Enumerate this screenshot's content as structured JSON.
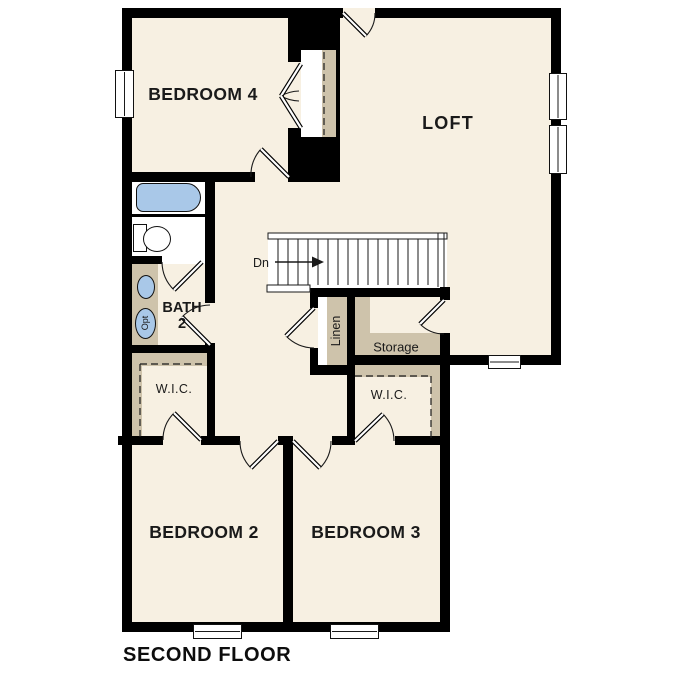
{
  "title": "SECOND FLOOR",
  "colors": {
    "background": "#ffffff",
    "floor": "#f7f0e2",
    "wall": "#000000",
    "closet_tan": "#cec3ab",
    "fixture_blue": "#a9c8e8",
    "line": "#1a1a1a"
  },
  "rooms": {
    "bedroom4": {
      "label": "BEDROOM 4"
    },
    "loft": {
      "label": "LOFT"
    },
    "bath": {
      "label_line1": "BATH",
      "label_line2": "2"
    },
    "wic_left": {
      "label": "W.I.C."
    },
    "wic_right": {
      "label": "W.I.C."
    },
    "bedroom2": {
      "label": "BEDROOM 2"
    },
    "bedroom3": {
      "label": "BEDROOM 3"
    },
    "linen": {
      "label": "Linen"
    },
    "storage": {
      "label": "Storage"
    }
  },
  "stairs": {
    "down_label": "Dn"
  },
  "fixtures": {
    "optional_label": "Opt"
  }
}
